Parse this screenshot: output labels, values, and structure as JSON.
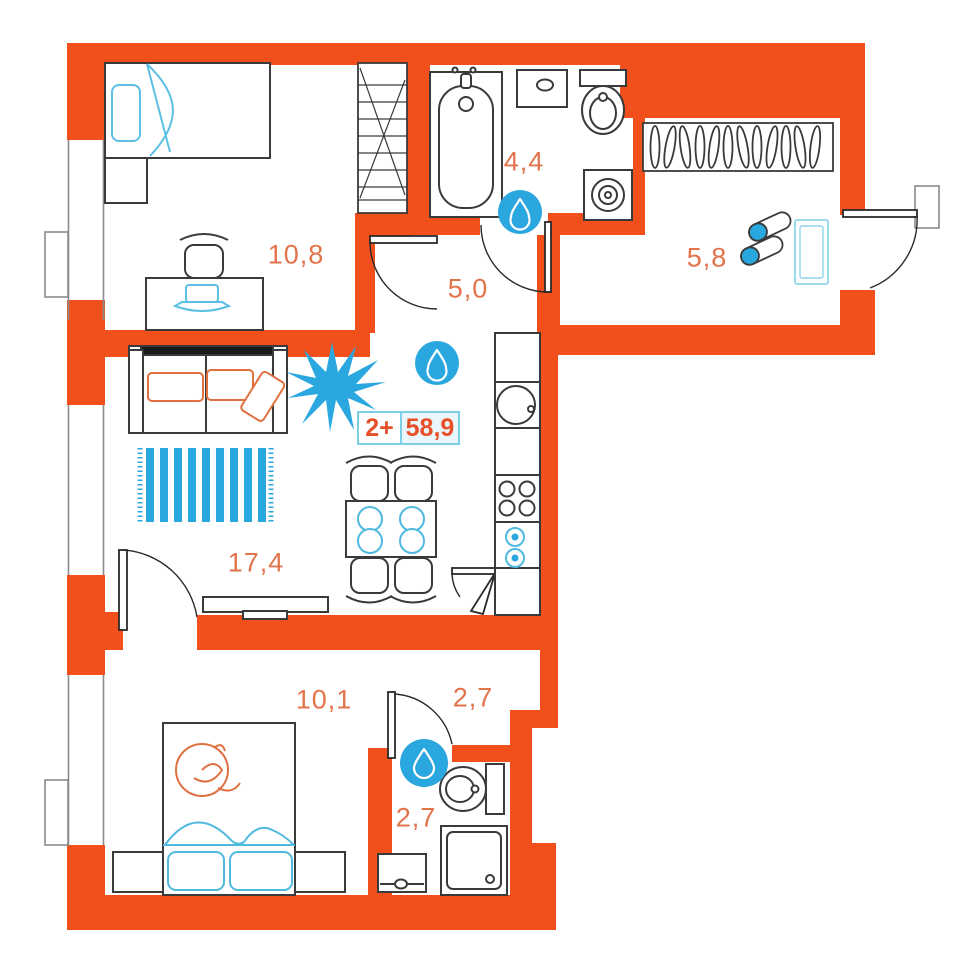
{
  "plan": {
    "unit": {
      "type_label": "2+",
      "area_label": "58,9"
    },
    "rooms": [
      {
        "name": "bedroom-1",
        "area": "10,8"
      },
      {
        "name": "bathroom-1",
        "area": "4,4"
      },
      {
        "name": "hallway",
        "area": "5,0"
      },
      {
        "name": "entry-hall",
        "area": "5,8"
      },
      {
        "name": "living-kitchen",
        "area": "17,4"
      },
      {
        "name": "bedroom-2",
        "area": "10,1"
      },
      {
        "name": "corridor",
        "area": "2,7"
      },
      {
        "name": "bathroom-2",
        "area": "2,7"
      }
    ],
    "icons": {
      "water_drop_count": 3
    },
    "colors": {
      "wall": "#f1501d",
      "accent_blue": "#2aa7df",
      "light_blue": "#5bc0e4",
      "room_label": "#e2734b",
      "badge_text": "#e8502a",
      "badge_border": "#7ccfe3",
      "furniture_line": "#3a3a3a"
    }
  }
}
